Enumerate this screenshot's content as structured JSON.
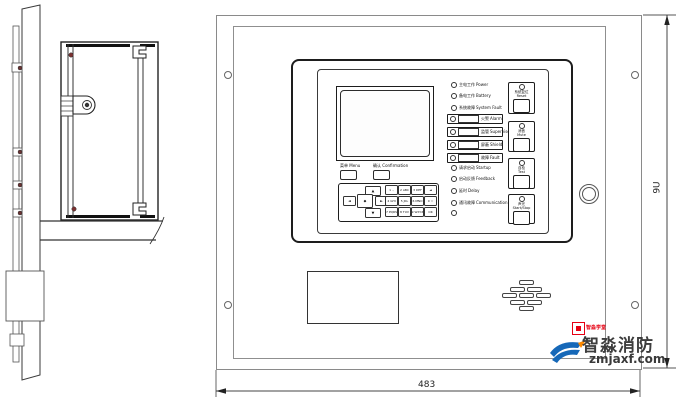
{
  "front": {
    "menu": {
      "ch": "菜单",
      "en": "Menu"
    },
    "confirm": {
      "ch": "确认",
      "en": "Confirmation"
    },
    "leds": [
      {
        "ch": "主电工作",
        "en": "Power"
      },
      {
        "ch": "备电工作",
        "en": "Battery"
      },
      {
        "ch": "系统故障",
        "en": "System Fault"
      },
      {
        "ch": "火警",
        "en": "Alarm"
      },
      {
        "ch": "监管",
        "en": "Supervise"
      },
      {
        "ch": "屏蔽",
        "en": "Shield"
      },
      {
        "ch": "故障",
        "en": "Fault"
      },
      {
        "ch": "请求启动",
        "en": "Startup"
      },
      {
        "ch": "启动反馈",
        "en": "Feedback"
      },
      {
        "ch": "延时",
        "en": "Delay"
      },
      {
        "ch": "通讯故障",
        "en": "Communication"
      },
      {
        "ch": "",
        "en": ""
      }
    ],
    "buttons": [
      {
        "ch": "系统复位",
        "en": "Reset"
      },
      {
        "ch": "消音",
        "en": "Mute"
      },
      {
        "ch": "自检",
        "en": "Test"
      },
      {
        "ch": "声光",
        "en": "Start/Stop"
      }
    ],
    "keypad": {
      "arrows": {
        "up": "▲",
        "left": "◄",
        "center": "◆",
        "right": "►",
        "down": "▼"
      },
      "keys": [
        "1 .,",
        "2 ABC",
        "3 DEF",
        "◄",
        "4 GHI",
        "5 JKL",
        "6 MNO",
        "0 ☆",
        "7 PQRS",
        "8 TUV",
        "9 WXYZ",
        "OK"
      ]
    }
  },
  "dimensions": {
    "width": "483",
    "height": "9U"
  },
  "watermark": {
    "badge": "智淼学堂",
    "brand": "智淼消防",
    "domain": "zmjaxf.com",
    "colors": {
      "red": "#e60012",
      "blue": "#1668b8",
      "orange": "#ff8a00"
    }
  }
}
